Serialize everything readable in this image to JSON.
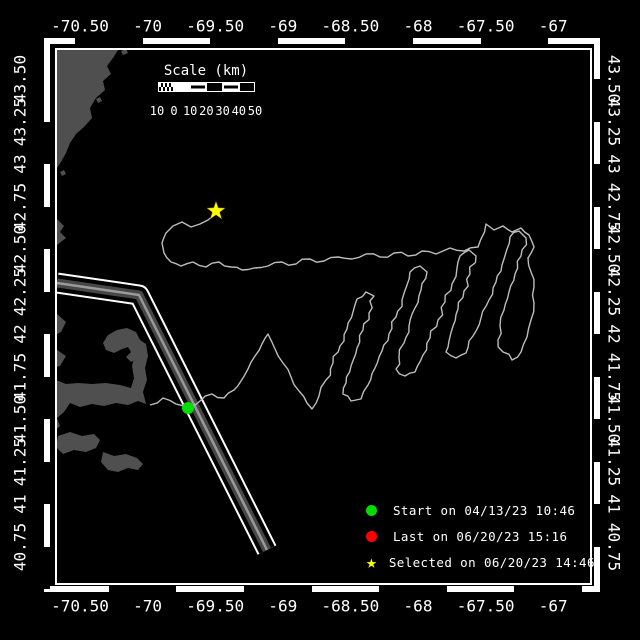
{
  "window": {
    "background": "#000000"
  },
  "colors": {
    "frame": "#ffffff",
    "land": "#4f4f4f",
    "track": "#bdbdbd",
    "lane_core": "#474747",
    "lane_stripe": "#9a9a9a",
    "start_marker": "#00dd00",
    "last_marker": "#ff0000",
    "selected_marker": "#ffff00"
  },
  "axes": {
    "lon_tick_labels": [
      "-70.50",
      "-70",
      "-69.50",
      "-69",
      "-68.50",
      "-68",
      "-67.50",
      "-67"
    ],
    "lat_tick_labels": [
      "43.50",
      "43.25",
      "43",
      "42.75",
      "42.50",
      "42.25",
      "42",
      "41.75",
      "41.50",
      "41.25",
      "41",
      "40.75"
    ]
  },
  "scale_bar": {
    "title": "Scale (km)",
    "tick_labels": [
      "10",
      "0",
      "10",
      "20",
      "30",
      "40",
      "50"
    ],
    "segments": [
      "checker",
      "solid",
      "striped",
      "outline",
      "striped",
      "outline"
    ]
  },
  "legend": {
    "items": [
      {
        "marker": "circle",
        "color": "#00dd00",
        "label": "Start on 04/13/23 10:46"
      },
      {
        "marker": "circle",
        "color": "#ff0000",
        "label": "Last on 06/20/23 15:16"
      },
      {
        "marker": "star",
        "color": "#ffff00",
        "label": "Selected on 06/20/23 14:46"
      }
    ]
  },
  "chart_data": {
    "type": "map-track",
    "lon_range": [
      -70.67,
      -66.72
    ],
    "lat_range": [
      40.93,
      43.65
    ],
    "markers": {
      "start": {
        "x": 188,
        "y": 408
      },
      "selected": {
        "x": 216,
        "y": 211
      }
    },
    "shipping_lane": [
      [
        57,
        283
      ],
      [
        139,
        295
      ],
      [
        267,
        550
      ]
    ],
    "track": [
      [
        150,
        405
      ],
      [
        163,
        398
      ],
      [
        176,
        404
      ],
      [
        188,
        408
      ],
      [
        200,
        401
      ],
      [
        212,
        394
      ],
      [
        224,
        398
      ],
      [
        234,
        390
      ],
      [
        241,
        381
      ],
      [
        248,
        369
      ],
      [
        255,
        356
      ],
      [
        262,
        344
      ],
      [
        268,
        334
      ],
      [
        275,
        349
      ],
      [
        283,
        363
      ],
      [
        291,
        377
      ],
      [
        299,
        391
      ],
      [
        307,
        403
      ],
      [
        312,
        409
      ],
      [
        319,
        396
      ],
      [
        326,
        380
      ],
      [
        333,
        363
      ],
      [
        340,
        346
      ],
      [
        347,
        329
      ],
      [
        353,
        312
      ],
      [
        357,
        299
      ],
      [
        366,
        292
      ],
      [
        374,
        296
      ],
      [
        369,
        313
      ],
      [
        363,
        330
      ],
      [
        357,
        348
      ],
      [
        351,
        366
      ],
      [
        346,
        383
      ],
      [
        343,
        394
      ],
      [
        351,
        401
      ],
      [
        361,
        399
      ],
      [
        368,
        385
      ],
      [
        375,
        368
      ],
      [
        382,
        351
      ],
      [
        389,
        334
      ],
      [
        396,
        317
      ],
      [
        402,
        300
      ],
      [
        407,
        285
      ],
      [
        410,
        272
      ],
      [
        420,
        266
      ],
      [
        427,
        272
      ],
      [
        421,
        290
      ],
      [
        415,
        308
      ],
      [
        409,
        326
      ],
      [
        404,
        343
      ],
      [
        399,
        358
      ],
      [
        396,
        369
      ],
      [
        405,
        376
      ],
      [
        415,
        372
      ],
      [
        423,
        355
      ],
      [
        430,
        338
      ],
      [
        438,
        320
      ],
      [
        445,
        302
      ],
      [
        452,
        284
      ],
      [
        457,
        268
      ],
      [
        460,
        256
      ],
      [
        469,
        250
      ],
      [
        476,
        256
      ],
      [
        470,
        274
      ],
      [
        464,
        291
      ],
      [
        458,
        309
      ],
      [
        453,
        326
      ],
      [
        449,
        341
      ],
      [
        446,
        352
      ],
      [
        456,
        358
      ],
      [
        466,
        353
      ],
      [
        473,
        336
      ],
      [
        481,
        318
      ],
      [
        489,
        300
      ],
      [
        496,
        282
      ],
      [
        502,
        265
      ],
      [
        507,
        249
      ],
      [
        510,
        237
      ],
      [
        519,
        231
      ],
      [
        526,
        238
      ],
      [
        521,
        256
      ],
      [
        515,
        274
      ],
      [
        509,
        292
      ],
      [
        504,
        310
      ],
      [
        500,
        326
      ],
      [
        498,
        340
      ],
      [
        503,
        352
      ],
      [
        512,
        360
      ],
      [
        521,
        352
      ],
      [
        527,
        337
      ],
      [
        531,
        320
      ],
      [
        534,
        303
      ],
      [
        534,
        287
      ],
      [
        531,
        272
      ],
      [
        528,
        258
      ],
      [
        534,
        247
      ],
      [
        529,
        235
      ],
      [
        521,
        228
      ],
      [
        512,
        232
      ],
      [
        503,
        226
      ],
      [
        494,
        230
      ],
      [
        486,
        224
      ],
      [
        478,
        247
      ],
      [
        464,
        251
      ],
      [
        450,
        248
      ],
      [
        436,
        254
      ],
      [
        422,
        251
      ],
      [
        408,
        256
      ],
      [
        394,
        253
      ],
      [
        380,
        257
      ],
      [
        366,
        254
      ],
      [
        352,
        259
      ],
      [
        338,
        257
      ],
      [
        324,
        261
      ],
      [
        310,
        259
      ],
      [
        296,
        264
      ],
      [
        282,
        262
      ],
      [
        268,
        266
      ],
      [
        254,
        268
      ],
      [
        242,
        270
      ],
      [
        231,
        267
      ],
      [
        219,
        262
      ],
      [
        206,
        267
      ],
      [
        193,
        262
      ],
      [
        181,
        266
      ],
      [
        171,
        262
      ],
      [
        164,
        253
      ],
      [
        162,
        243
      ],
      [
        166,
        233
      ],
      [
        173,
        226
      ],
      [
        182,
        222
      ],
      [
        191,
        227
      ],
      [
        200,
        224
      ],
      [
        208,
        220
      ],
      [
        213,
        216
      ],
      [
        216,
        211
      ]
    ],
    "land": [
      [
        [
          57,
          50
        ],
        [
          118,
          50
        ],
        [
          113,
          58
        ],
        [
          107,
          66
        ],
        [
          111,
          74
        ],
        [
          103,
          81
        ],
        [
          105,
          90
        ],
        [
          96,
          98
        ],
        [
          90,
          108
        ],
        [
          92,
          118
        ],
        [
          84,
          127
        ],
        [
          76,
          134
        ],
        [
          70,
          143
        ],
        [
          66,
          153
        ],
        [
          61,
          162
        ],
        [
          57,
          168
        ]
      ],
      [
        [
          48,
          221
        ],
        [
          57,
          219
        ],
        [
          64,
          226
        ],
        [
          60,
          232
        ],
        [
          66,
          238
        ],
        [
          57,
          245
        ],
        [
          48,
          241
        ]
      ],
      [
        [
          47,
          310
        ],
        [
          57,
          314
        ],
        [
          66,
          322
        ],
        [
          61,
          332
        ],
        [
          53,
          336
        ],
        [
          49,
          344
        ],
        [
          57,
          350
        ],
        [
          66,
          356
        ],
        [
          60,
          366
        ],
        [
          50,
          368
        ],
        [
          47,
          374
        ],
        [
          47,
          380
        ],
        [
          56,
          380
        ],
        [
          66,
          384
        ],
        [
          78,
          383
        ],
        [
          92,
          384
        ],
        [
          106,
          383
        ],
        [
          120,
          385
        ],
        [
          131,
          388
        ],
        [
          134,
          378
        ],
        [
          132,
          366
        ],
        [
          135,
          354
        ],
        [
          134,
          344
        ],
        [
          140,
          340
        ],
        [
          146,
          344
        ],
        [
          148,
          356
        ],
        [
          145,
          368
        ],
        [
          147,
          380
        ],
        [
          143,
          392
        ],
        [
          146,
          404
        ],
        [
          138,
          401
        ],
        [
          128,
          405
        ],
        [
          116,
          403
        ],
        [
          104,
          406
        ],
        [
          92,
          404
        ],
        [
          80,
          407
        ],
        [
          70,
          403
        ],
        [
          64,
          412
        ],
        [
          57,
          418
        ],
        [
          60,
          426
        ],
        [
          53,
          432
        ],
        [
          57,
          441
        ],
        [
          50,
          448
        ],
        [
          47,
          452
        ]
      ],
      [
        [
          140,
          340
        ],
        [
          136,
          332
        ],
        [
          127,
          328
        ],
        [
          117,
          330
        ],
        [
          108,
          335
        ],
        [
          103,
          343
        ],
        [
          106,
          350
        ],
        [
          114,
          353
        ],
        [
          122,
          349
        ],
        [
          128,
          347
        ],
        [
          131,
          352
        ],
        [
          126,
          357
        ],
        [
          131,
          362
        ],
        [
          138,
          358
        ],
        [
          141,
          350
        ]
      ],
      [
        [
          58,
          436
        ],
        [
          70,
          432
        ],
        [
          82,
          436
        ],
        [
          94,
          434
        ],
        [
          100,
          440
        ],
        [
          96,
          448
        ],
        [
          86,
          452
        ],
        [
          74,
          450
        ],
        [
          63,
          454
        ],
        [
          56,
          447
        ]
      ],
      [
        [
          103,
          452
        ],
        [
          114,
          456
        ],
        [
          126,
          454
        ],
        [
          137,
          458
        ],
        [
          143,
          464
        ],
        [
          138,
          470
        ],
        [
          128,
          468
        ],
        [
          118,
          472
        ],
        [
          108,
          470
        ],
        [
          101,
          462
        ]
      ],
      [
        [
          121,
          51
        ],
        [
          126,
          49
        ],
        [
          128,
          53
        ],
        [
          123,
          55
        ]
      ],
      [
        [
          96,
          99
        ],
        [
          100,
          97
        ],
        [
          102,
          101
        ],
        [
          98,
          103
        ]
      ],
      [
        [
          60,
          172
        ],
        [
          64,
          170
        ],
        [
          66,
          174
        ],
        [
          62,
          176
        ]
      ]
    ]
  }
}
